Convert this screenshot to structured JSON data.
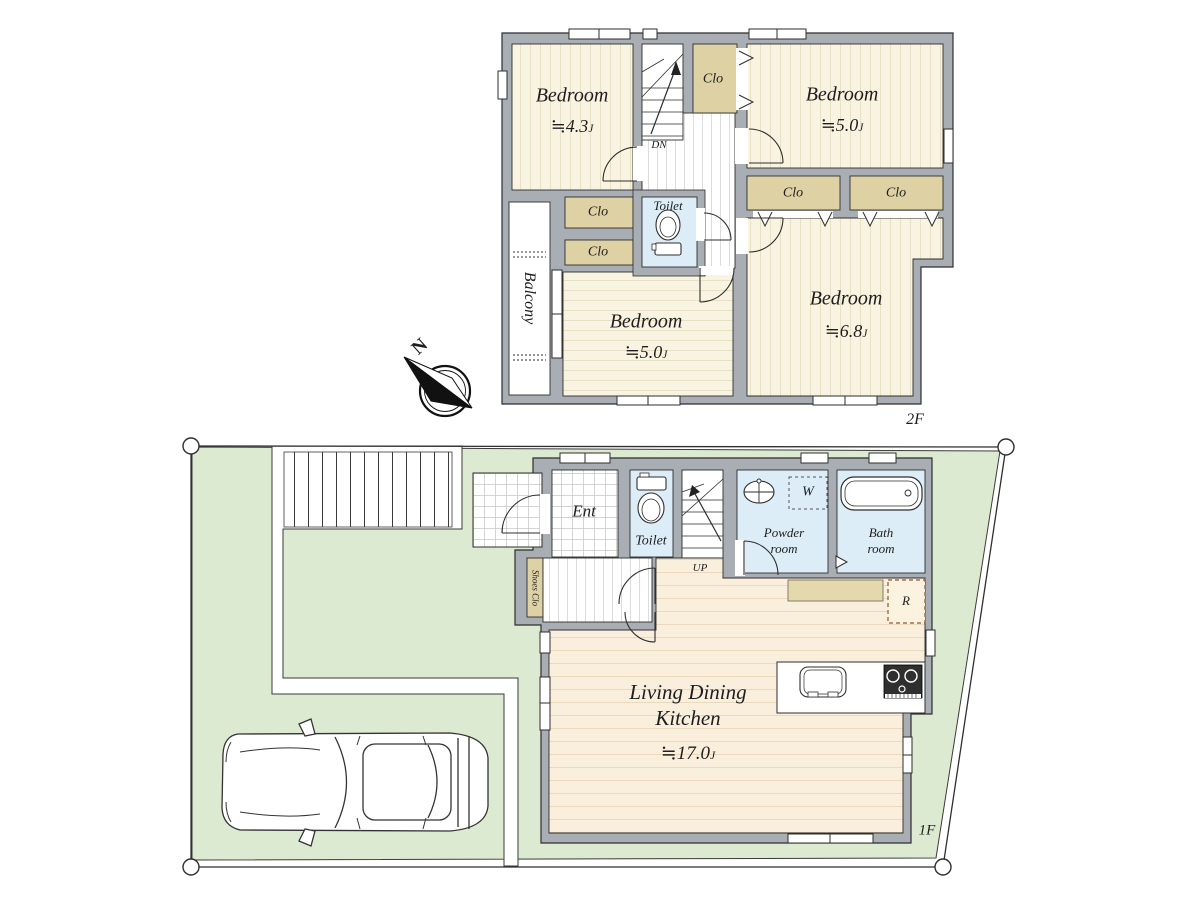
{
  "floors": {
    "f2": {
      "floor_label": "2F",
      "bedroom_nw": {
        "name": "Bedroom",
        "size": "≒4.3",
        "unit": "J"
      },
      "bedroom_ne": {
        "name": "Bedroom",
        "size": "≒5.0",
        "unit": "J"
      },
      "bedroom_sw": {
        "name": "Bedroom",
        "size": "≒5.0",
        "unit": "J"
      },
      "bedroom_se": {
        "name": "Bedroom",
        "size": "≒6.8",
        "unit": "J"
      },
      "closet_label": "Clo",
      "toilet_label": "Toilet",
      "balcony_label": "Balcony",
      "stairs_down_label": "DN"
    },
    "f1": {
      "floor_label": "1F",
      "entrance_label": "Ent",
      "toilet_label": "Toilet",
      "stairs_up_label": "UP",
      "powder_room_label": "Powder room",
      "bath_room_label": "Bath room",
      "washer_label": "W",
      "refrigerator_label": "R",
      "shoes_closet_label": "Shoes Clo",
      "ldk": {
        "name": "Living Dining Kitchen",
        "size": "≒17.0",
        "unit": "J"
      }
    }
  },
  "compass": {
    "north_label": "N"
  },
  "colors": {
    "site_green": "#dcead2",
    "wall_gray": "#a9aeb4",
    "room_cream": "#f8f4e1",
    "closet_tan": "#ded2a5",
    "water_blue": "#ddedf8",
    "wood_floor": "#faeedd"
  }
}
